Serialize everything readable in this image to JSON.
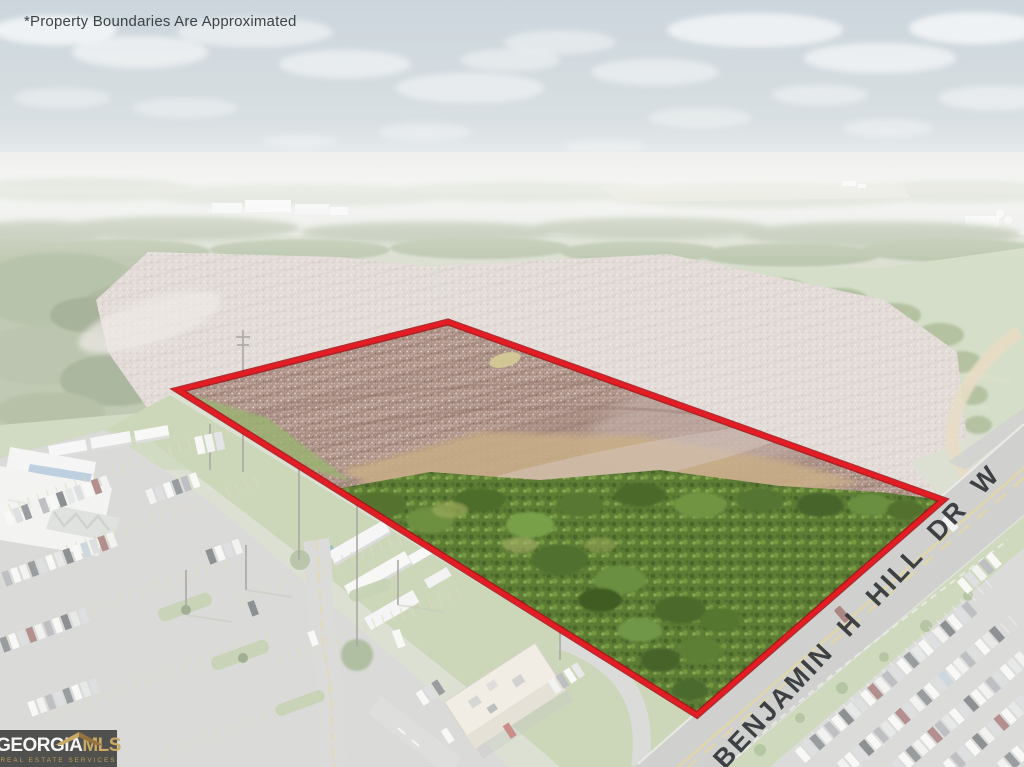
{
  "photo": {
    "disclaimer": "*Property Boundaries Are Approximated",
    "street_label": "BENJAMIN H HILL DR W"
  },
  "logo": {
    "brand_primary": "GEORGIA",
    "brand_secondary": "MLS",
    "tagline": "REAL ESTATE SERVICES"
  },
  "colors": {
    "boundary_red": "#e51c23",
    "logo_gold": "#c9a964",
    "logo_background": "#474745"
  }
}
